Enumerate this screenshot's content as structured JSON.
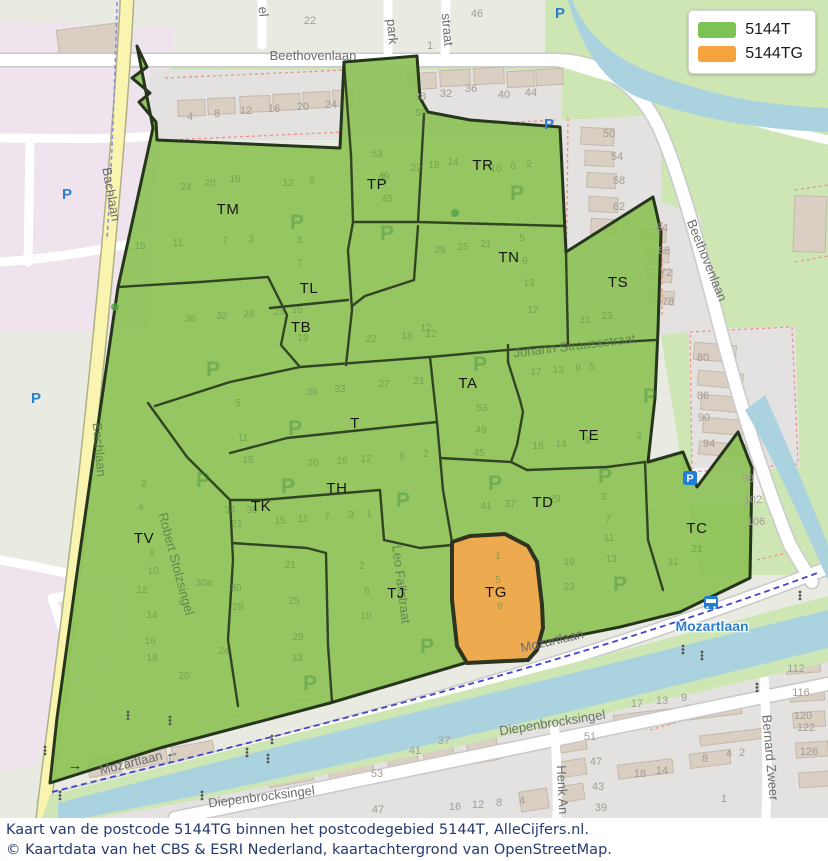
{
  "legend": {
    "items": [
      {
        "label": "5144T",
        "color": "#7dc254"
      },
      {
        "label": "5144TG",
        "color": "#f5a33c"
      }
    ]
  },
  "caption": {
    "line1": "Kaart van de postcode 5144TG binnen het postcodegebied 5144T, AlleCijfers.nl.",
    "line2": "© Kaartdata van het CBS & ESRI Nederland, kaartachtergrond van OpenStreetMap."
  },
  "map": {
    "colors": {
      "area_5144T_fill": "#8dc257",
      "area_5144TG_fill": "#edaa4e",
      "area_border": "#25361c",
      "water": "#aad3df",
      "park_green": "#cde6b4",
      "residential_gray": "#e3e2e0",
      "retail_pink": "#efe3ee",
      "building_tan": "#d9cfc3",
      "road_yellow": "#f9f5b0",
      "caption_text": "#253a6e"
    },
    "region_labels": [
      {
        "t": "TM",
        "x": 228,
        "y": 214
      },
      {
        "t": "TP",
        "x": 377,
        "y": 189
      },
      {
        "t": "TR",
        "x": 483,
        "y": 170
      },
      {
        "t": "TN",
        "x": 509,
        "y": 262
      },
      {
        "t": "TS",
        "x": 618,
        "y": 287
      },
      {
        "t": "TL",
        "x": 309,
        "y": 293
      },
      {
        "t": "TB",
        "x": 301,
        "y": 332
      },
      {
        "t": "TA",
        "x": 468,
        "y": 388
      },
      {
        "t": "T",
        "x": 355,
        "y": 428
      },
      {
        "t": "TE",
        "x": 589,
        "y": 440
      },
      {
        "t": "TH",
        "x": 337,
        "y": 493
      },
      {
        "t": "TK",
        "x": 261,
        "y": 511
      },
      {
        "t": "TD",
        "x": 543,
        "y": 507
      },
      {
        "t": "TC",
        "x": 697,
        "y": 533
      },
      {
        "t": "TV",
        "x": 144,
        "y": 543
      },
      {
        "t": "TJ",
        "x": 396,
        "y": 598
      },
      {
        "t": "TG",
        "x": 496,
        "y": 597
      }
    ],
    "street_labels": [
      {
        "t": "Beethovenlaan",
        "x": 313,
        "y": 60,
        "r": 0,
        "c": "road",
        "s": 14
      },
      {
        "t": "Beethovenlaan",
        "x": 703,
        "y": 262,
        "r": 68,
        "c": "road",
        "s": 14
      },
      {
        "t": "Bachlaan",
        "x": 107,
        "y": 195,
        "r": 80,
        "c": "road",
        "s": 13
      },
      {
        "t": "Bachlaan",
        "x": 95,
        "y": 450,
        "r": 85,
        "c": "faint",
        "s": 13
      },
      {
        "t": "Robert Stolzsingel",
        "x": 172,
        "y": 565,
        "r": 75,
        "c": "faint",
        "s": 13
      },
      {
        "t": "Leo Fallstraat",
        "x": 397,
        "y": 585,
        "r": 83,
        "c": "faint",
        "s": 13
      },
      {
        "t": "Johann Straussstraat",
        "x": 575,
        "y": 350,
        "r": -7,
        "c": "faint",
        "s": 14
      },
      {
        "t": "Mozartlaan",
        "x": 553,
        "y": 645,
        "r": -13,
        "c": "road",
        "s": 14
      },
      {
        "t": "Mozartlaan →",
        "x": 140,
        "y": 765,
        "r": -14,
        "c": "road",
        "s": 14
      },
      {
        "t": "Diepenbrocksingel",
        "x": 553,
        "y": 727,
        "r": -9,
        "c": "road",
        "s": 14
      },
      {
        "t": "Diepenbrocksingel",
        "x": 262,
        "y": 801,
        "r": -7,
        "c": "road",
        "s": 14
      },
      {
        "t": "Henk An",
        "x": 558,
        "y": 790,
        "r": 87,
        "c": "road",
        "s": 13
      },
      {
        "t": "Bernard Zweer",
        "x": 766,
        "y": 758,
        "r": 85,
        "c": "road",
        "s": 13
      },
      {
        "t": "park",
        "x": 388,
        "y": 32,
        "r": 85,
        "c": "road",
        "s": 12
      },
      {
        "t": "straat",
        "x": 443,
        "y": 30,
        "r": 85,
        "c": "road",
        "s": 12
      },
      {
        "t": "el",
        "x": 259,
        "y": 12,
        "r": 85,
        "c": "road",
        "s": 12
      },
      {
        "t": "Mozartlaan",
        "x": 712,
        "y": 631,
        "r": 0,
        "c": "transit",
        "s": 14
      }
    ],
    "house_numbers": {
      "outside": [
        [
          22,
          310,
          24
        ],
        [
          1,
          430,
          49
        ],
        [
          46,
          477,
          17
        ],
        [
          4,
          190,
          120
        ],
        [
          8,
          217,
          117
        ],
        [
          12,
          246,
          114
        ],
        [
          16,
          274,
          112
        ],
        [
          20,
          303,
          110
        ],
        [
          24,
          331,
          108
        ],
        [
          28,
          420,
          100
        ],
        [
          32,
          446,
          97
        ],
        [
          36,
          471,
          92
        ],
        [
          40,
          504,
          98
        ],
        [
          44,
          531,
          96
        ],
        [
          50,
          609,
          137
        ],
        [
          54,
          617,
          160
        ],
        [
          58,
          619,
          184
        ],
        [
          62,
          619,
          210
        ],
        [
          64,
          662,
          231
        ],
        [
          68,
          664,
          254
        ],
        [
          72,
          666,
          276
        ],
        [
          78,
          668,
          305
        ],
        [
          80,
          703,
          361
        ],
        [
          86,
          703,
          399
        ],
        [
          90,
          704,
          421
        ],
        [
          94,
          709,
          447
        ],
        [
          98,
          748,
          482
        ],
        [
          102,
          753,
          503
        ],
        [
          106,
          756,
          525
        ],
        [
          112,
          796,
          672
        ],
        [
          116,
          801,
          696
        ],
        [
          120,
          803,
          719
        ],
        [
          122,
          806,
          731
        ],
        [
          126,
          809,
          755
        ],
        [
          41,
          415,
          754
        ],
        [
          37,
          444,
          744
        ],
        [
          51,
          590,
          740
        ],
        [
          47,
          596,
          765
        ],
        [
          43,
          598,
          790
        ],
        [
          39,
          601,
          811
        ],
        [
          53,
          377,
          777
        ],
        [
          47,
          378,
          813
        ],
        [
          17,
          637,
          707
        ],
        [
          13,
          662,
          704
        ],
        [
          9,
          684,
          701
        ],
        [
          18,
          640,
          777
        ],
        [
          14,
          662,
          774
        ],
        [
          8,
          705,
          762
        ],
        [
          4,
          729,
          757
        ],
        [
          2,
          742,
          756
        ],
        [
          1,
          724,
          802
        ],
        [
          16,
          455,
          810
        ],
        [
          12,
          478,
          808
        ],
        [
          8,
          499,
          806
        ],
        [
          4,
          522,
          804
        ]
      ],
      "inside": [
        [
          24,
          186,
          190
        ],
        [
          20,
          210,
          186
        ],
        [
          16,
          235,
          182
        ],
        [
          12,
          288,
          186
        ],
        [
          8,
          312,
          184
        ],
        [
          2,
          383,
          181
        ],
        [
          15,
          140,
          249
        ],
        [
          11,
          178,
          246
        ],
        [
          7,
          225,
          244
        ],
        [
          3,
          251,
          242
        ],
        [
          36,
          190,
          322
        ],
        [
          32,
          222,
          319
        ],
        [
          28,
          249,
          317
        ],
        [
          24,
          279,
          315
        ],
        [
          3,
          299,
          243
        ],
        [
          7,
          300,
          266
        ],
        [
          15,
          297,
          313
        ],
        [
          19,
          303,
          341
        ],
        [
          53,
          377,
          157
        ],
        [
          49,
          384,
          179
        ],
        [
          45,
          387,
          202
        ],
        [
          59,
          421,
          116
        ],
        [
          22,
          416,
          171
        ],
        [
          18,
          434,
          168
        ],
        [
          14,
          453,
          165
        ],
        [
          10,
          496,
          172
        ],
        [
          6,
          513,
          169
        ],
        [
          2,
          529,
          167
        ],
        [
          29,
          440,
          253
        ],
        [
          25,
          463,
          250
        ],
        [
          21,
          486,
          247
        ],
        [
          5,
          522,
          241
        ],
        [
          9,
          525,
          264
        ],
        [
          13,
          529,
          286
        ],
        [
          17,
          533,
          313
        ],
        [
          12,
          426,
          331
        ],
        [
          22,
          371,
          342
        ],
        [
          16,
          407,
          339
        ],
        [
          12,
          431,
          337
        ],
        [
          31,
          585,
          323
        ],
        [
          23,
          607,
          319
        ],
        [
          53,
          482,
          411
        ],
        [
          49,
          481,
          433
        ],
        [
          45,
          479,
          456
        ],
        [
          17,
          536,
          375
        ],
        [
          13,
          558,
          373
        ],
        [
          9,
          578,
          371
        ],
        [
          5,
          592,
          370
        ],
        [
          18,
          538,
          449
        ],
        [
          14,
          561,
          447
        ],
        [
          8,
          588,
          444
        ],
        [
          2,
          639,
          439
        ],
        [
          41,
          486,
          509
        ],
        [
          37,
          510,
          507
        ],
        [
          29,
          555,
          502
        ],
        [
          3,
          604,
          500
        ],
        [
          7,
          608,
          522
        ],
        [
          11,
          609,
          541
        ],
        [
          13,
          611,
          562
        ],
        [
          19,
          569,
          565
        ],
        [
          23,
          569,
          590
        ],
        [
          21,
          697,
          552
        ],
        [
          31,
          673,
          565
        ],
        [
          33,
          340,
          392
        ],
        [
          27,
          384,
          387
        ],
        [
          21,
          419,
          384
        ],
        [
          39,
          312,
          395
        ],
        [
          20,
          313,
          466
        ],
        [
          16,
          342,
          464
        ],
        [
          12,
          366,
          462
        ],
        [
          6,
          402,
          459
        ],
        [
          2,
          426,
          457
        ],
        [
          21,
          237,
          527
        ],
        [
          15,
          280,
          524
        ],
        [
          11,
          303,
          522
        ],
        [
          7,
          327,
          520
        ],
        [
          3,
          351,
          518
        ],
        [
          1,
          369,
          517
        ],
        [
          34,
          230,
          513
        ],
        [
          36,
          252,
          513
        ],
        [
          21,
          290,
          568
        ],
        [
          25,
          294,
          604
        ],
        [
          29,
          298,
          640
        ],
        [
          2,
          362,
          569
        ],
        [
          6,
          367,
          594
        ],
        [
          10,
          366,
          619
        ],
        [
          1,
          498,
          559
        ],
        [
          5,
          498,
          583
        ],
        [
          9,
          500,
          609
        ],
        [
          5,
          238,
          406
        ],
        [
          11,
          243,
          441
        ],
        [
          15,
          248,
          463
        ],
        [
          2,
          144,
          487
        ],
        [
          4,
          141,
          510
        ],
        [
          8,
          152,
          556
        ],
        [
          10,
          153,
          574
        ],
        [
          12,
          142,
          593
        ],
        [
          14,
          152,
          618
        ],
        [
          16,
          150,
          644
        ],
        [
          18,
          152,
          661
        ],
        [
          20,
          184,
          679
        ],
        [
          24,
          224,
          654
        ],
        [
          30,
          236,
          591
        ],
        [
          28,
          238,
          610
        ],
        [
          33,
          297,
          661
        ],
        [
          "30a",
          204,
          586
        ]
      ]
    },
    "parking_icons": [
      {
        "x": 297,
        "y": 229,
        "k": "g"
      },
      {
        "x": 387,
        "y": 240,
        "k": "g"
      },
      {
        "x": 517,
        "y": 200,
        "k": "g"
      },
      {
        "x": 480,
        "y": 371,
        "k": "g"
      },
      {
        "x": 650,
        "y": 403,
        "k": "g"
      },
      {
        "x": 295,
        "y": 435,
        "k": "g"
      },
      {
        "x": 288,
        "y": 493,
        "k": "g"
      },
      {
        "x": 403,
        "y": 507,
        "k": "g"
      },
      {
        "x": 495,
        "y": 490,
        "k": "g"
      },
      {
        "x": 605,
        "y": 483,
        "k": "g"
      },
      {
        "x": 620,
        "y": 591,
        "k": "g"
      },
      {
        "x": 427,
        "y": 653,
        "k": "g"
      },
      {
        "x": 310,
        "y": 690,
        "k": "g"
      },
      {
        "x": 213,
        "y": 376,
        "k": "g"
      },
      {
        "x": 203,
        "y": 487,
        "k": "g"
      },
      {
        "x": 67,
        "y": 199,
        "k": "b"
      },
      {
        "x": 36,
        "y": 403,
        "k": "b"
      },
      {
        "x": 549,
        "y": 129,
        "k": "b"
      },
      {
        "x": 560,
        "y": 18,
        "k": "b"
      },
      {
        "x": 690,
        "y": 481,
        "k": "box"
      }
    ],
    "transit_stop": {
      "label": "Mozartlaan",
      "bus_x": 704,
      "bus_y": 596
    },
    "traffic_lights": [
      [
        128,
        712
      ],
      [
        170,
        717
      ],
      [
        247,
        749
      ],
      [
        268,
        755
      ],
      [
        272,
        736
      ],
      [
        202,
        792
      ],
      [
        45,
        747
      ],
      [
        60,
        792
      ],
      [
        683,
        646
      ],
      [
        702,
        652
      ],
      [
        757,
        684
      ],
      [
        800,
        592
      ]
    ],
    "arrows": [
      {
        "t": "→",
        "x": 75,
        "y": 770
      },
      {
        "t": "↑",
        "x": 170,
        "y": 762
      }
    ],
    "trees": [
      [
        455,
        213
      ],
      [
        115,
        307
      ]
    ]
  }
}
